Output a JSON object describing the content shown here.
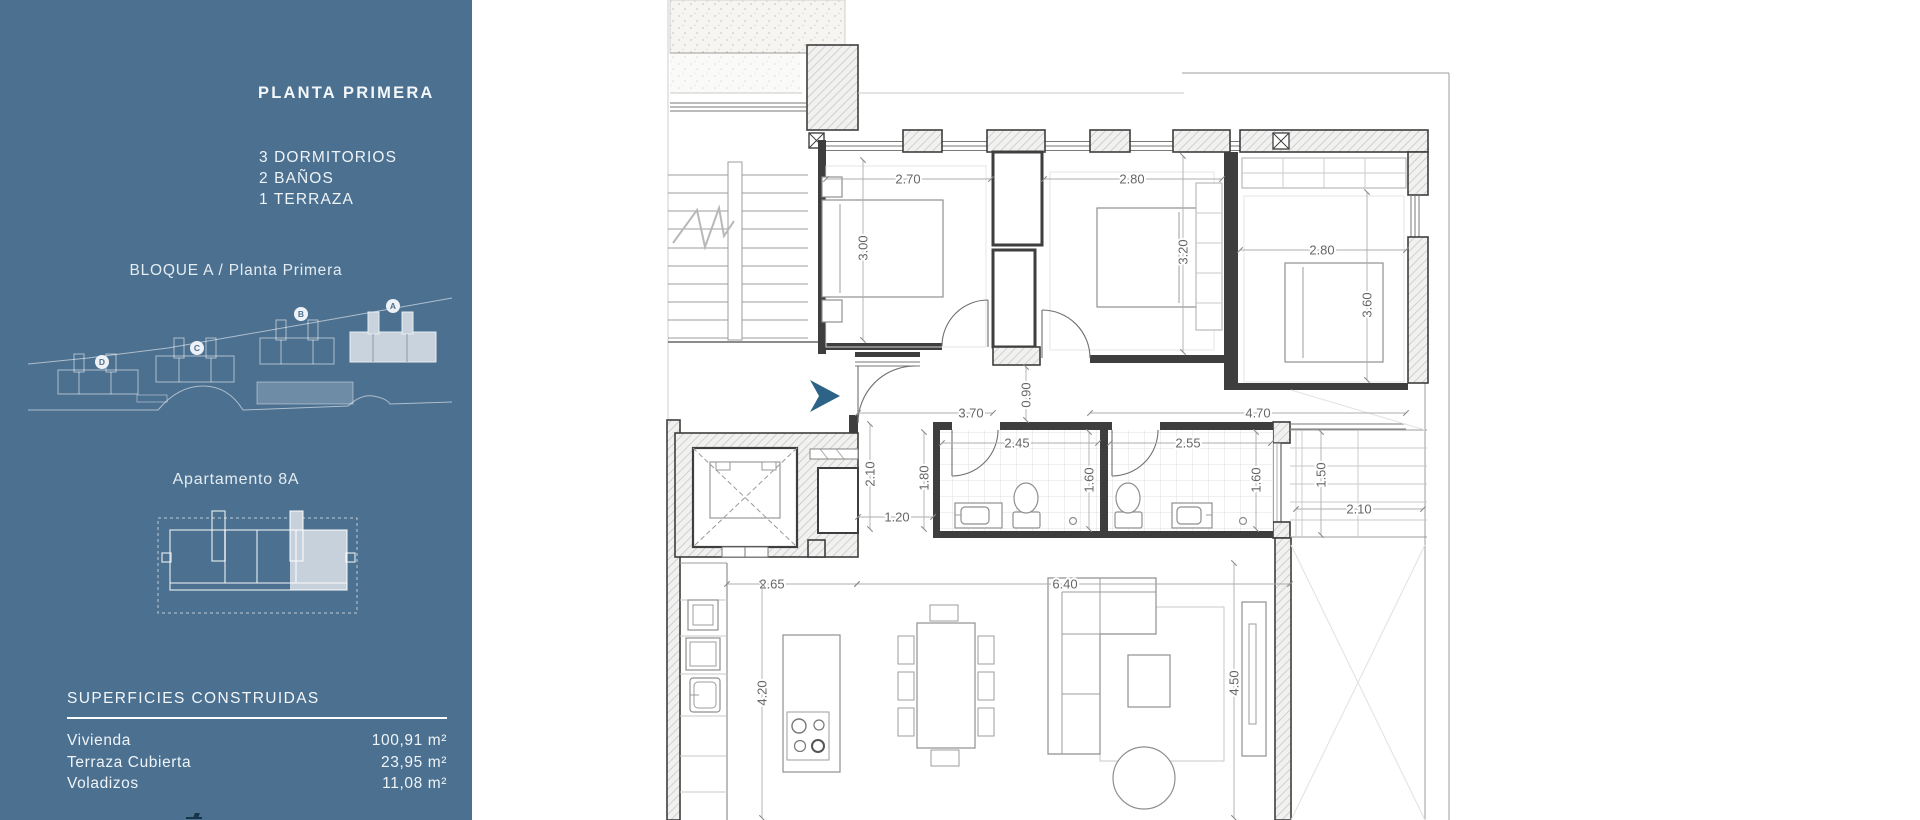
{
  "sidebar": {
    "background": "#4c7090",
    "title": "PLANTA PRIMERA",
    "features": [
      "3 DORMITORIOS",
      "2 BAÑOS",
      "1 TERRAZA"
    ],
    "block_title": "BLOQUE A / Planta Primera",
    "site_plan": {
      "blocks": [
        {
          "label": "D",
          "highlighted": false
        },
        {
          "label": "C",
          "highlighted": false
        },
        {
          "label": "B",
          "highlighted": false
        },
        {
          "label": "A",
          "highlighted": true
        }
      ]
    },
    "apartment_title": "Apartamento 8A",
    "surfaces": {
      "heading": "SUPERFICIES CONSTRUIDAS",
      "rows": [
        {
          "label": "Vivienda",
          "value": "100,91 m²"
        },
        {
          "label": "Terraza Cubierta",
          "value": "23,95 m²"
        },
        {
          "label": "Voladizos",
          "value": "11,08 m²"
        }
      ]
    }
  },
  "plan": {
    "colors": {
      "entry_arrow": "#2d6386",
      "walls": "#3e3e3e"
    },
    "dimensions": {
      "bedroom1_width": "2.70",
      "bedroom1_depth": "3.00",
      "bedroom2_width": "2.80",
      "bedroom2_depth": "3.20",
      "bedroom3_width": "2.80",
      "bedroom3_depth": "3.60",
      "hall_left": "3.70",
      "hall_door": "0.90",
      "hall_right": "4.70",
      "hall_depth": "2.10",
      "hall_passage": "1.20",
      "bath_entry_depth": "1.80",
      "bath1_width": "2.45",
      "bath1_depth": "1.60",
      "bath2_width": "2.55",
      "bath2_depth": "1.60",
      "steps_depth": "1.50",
      "steps_width": "2.10",
      "kitchen_width": "2.65",
      "kitchen_depth": "4.20",
      "living_width": "6.40",
      "living_depth": "4.50"
    }
  }
}
